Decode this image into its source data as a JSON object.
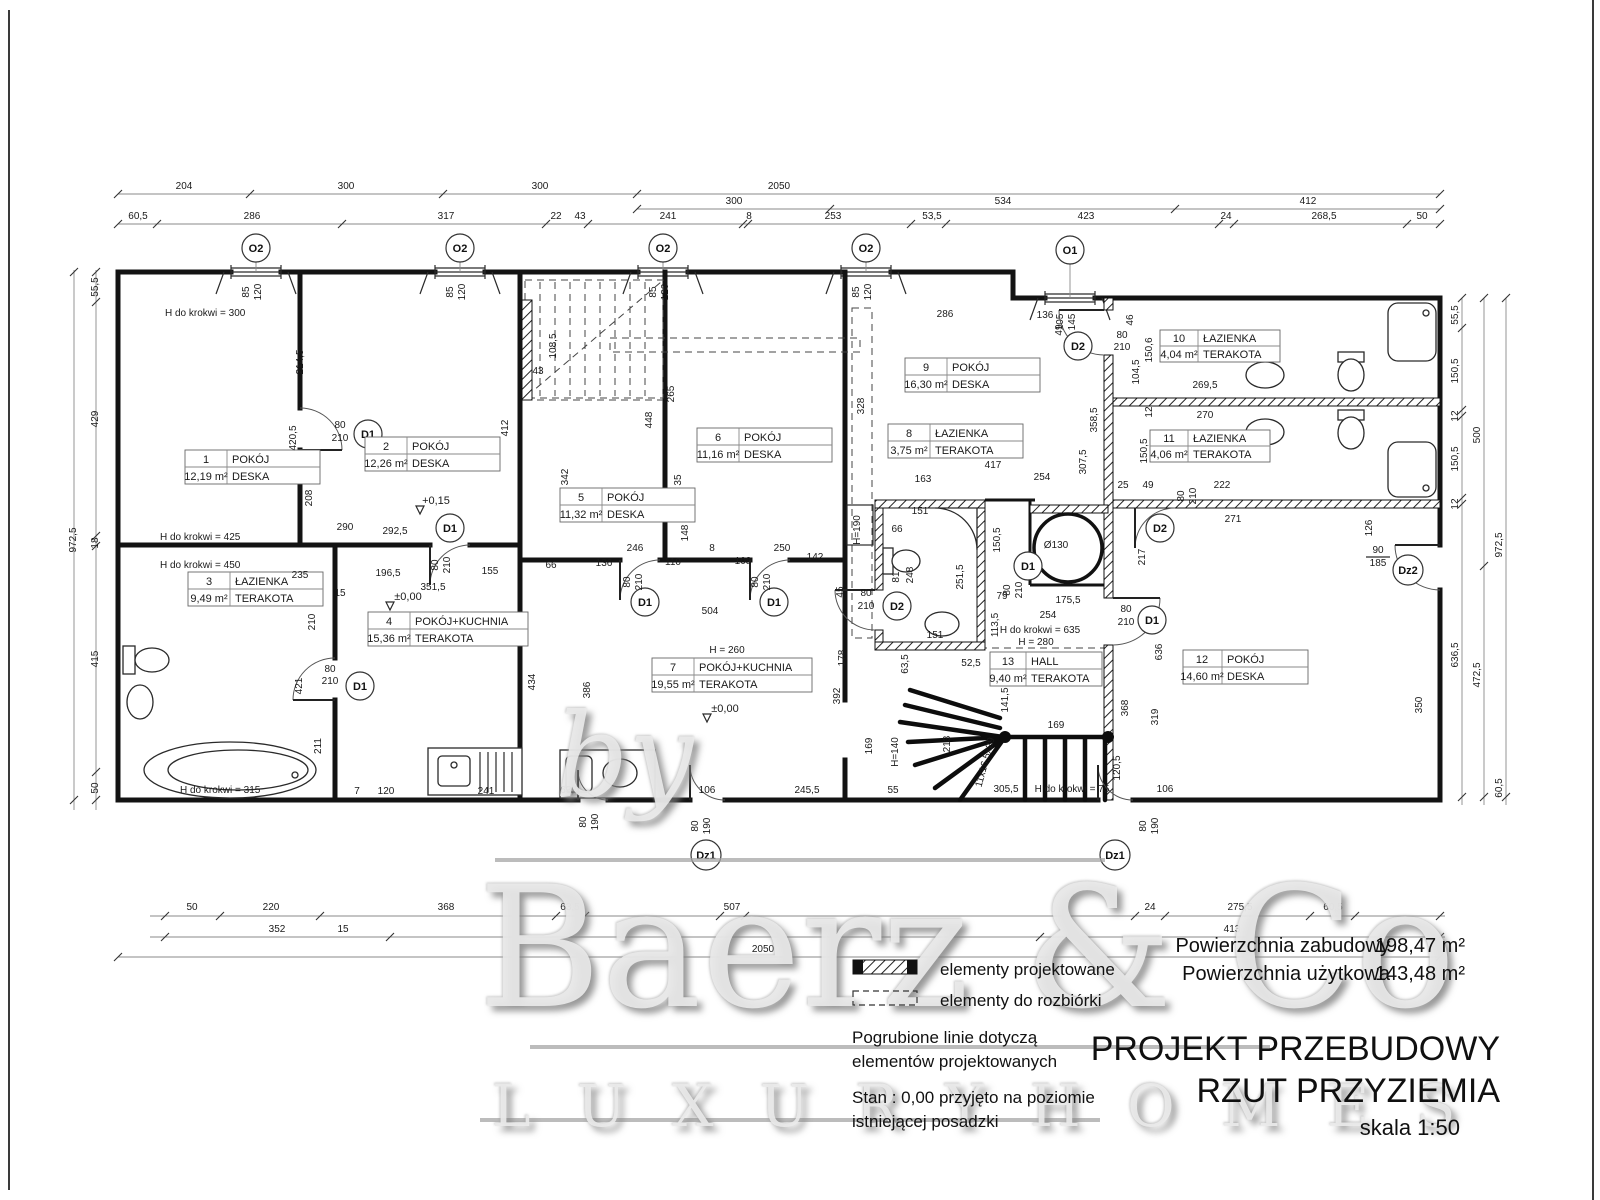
{
  "drawing": {
    "title_line1": "PROJEKT PRZEBUDOWY",
    "title_line2": "RZUT PRZYZIEMIA",
    "scale": "skala 1:50",
    "area_rows": [
      {
        "label": "Powierzchnia zabudowy",
        "value": "198,47 m²"
      },
      {
        "label": "Powierzchnia użytkowa",
        "value": "143,48 m²"
      }
    ]
  },
  "legend": {
    "item_projected": "elementy projektowane",
    "item_demolition": "elementy do rozbiórki",
    "note1a": "Pogrubione linie dotyczą",
    "note1b": "elementów projektowanych",
    "note2a": "Stan : 0,00 przyjęto na poziomie",
    "note2b": "istniejącej posadzki"
  },
  "watermark": {
    "by": "by",
    "name": "Baerz & Co",
    "tagline": "L U X U R Y   H O M E S"
  },
  "rooms": [
    {
      "num": "1",
      "name": "POKÓJ",
      "area": "12,19 m²",
      "floor": "DESKA"
    },
    {
      "num": "2",
      "name": "POKÓJ",
      "area": "12,26 m²",
      "floor": "DESKA"
    },
    {
      "num": "3",
      "name": "ŁAZIENKA",
      "area": "9,49 m²",
      "floor": "TERAKOTA"
    },
    {
      "num": "4",
      "name": "POKÓJ+KUCHNIA",
      "area": "15,36 m²",
      "floor": "TERAKOTA"
    },
    {
      "num": "5",
      "name": "POKÓJ",
      "area": "11,32 m²",
      "floor": "DESKA"
    },
    {
      "num": "6",
      "name": "POKÓJ",
      "area": "11,16 m²",
      "floor": "DESKA"
    },
    {
      "num": "7",
      "name": "POKÓJ+KUCHNIA",
      "area": "19,55 m²",
      "floor": "TERAKOTA"
    },
    {
      "num": "8",
      "name": "ŁAZIENKA",
      "area": "3,75 m²",
      "floor": "TERAKOTA"
    },
    {
      "num": "9",
      "name": "POKÓJ",
      "area": "16,30 m²",
      "floor": "DESKA"
    },
    {
      "num": "10",
      "name": "ŁAZIENKA",
      "area": "4,04 m²",
      "floor": "TERAKOTA"
    },
    {
      "num": "11",
      "name": "ŁAZIENKA",
      "area": "4,06 m²",
      "floor": "TERAKOTA"
    },
    {
      "num": "12",
      "name": "POKÓJ",
      "area": "14,60 m²",
      "floor": "DESKA"
    },
    {
      "num": "13",
      "name": "HALL",
      "area": "9,40 m²",
      "floor": "TERAKOTA"
    }
  ],
  "windows": {
    "o2": {
      "label": "O2",
      "w": "85",
      "h": "120"
    },
    "o1": {
      "label": "O1",
      "w": "105",
      "h": "145"
    }
  },
  "doors": {
    "d1": {
      "label": "D1",
      "w": "80",
      "h": "210"
    },
    "d2": {
      "label": "D2",
      "w": "80",
      "h": "210"
    },
    "dz1": {
      "label": "Dz1",
      "w": "80",
      "h": "190"
    },
    "dz2": {
      "label": "Dz2",
      "w": "90",
      "h": "185"
    }
  },
  "levels": {
    "zero": "±0,00",
    "plus": "+0,15"
  },
  "dims": {
    "top_a": [
      "204",
      "300",
      "300",
      "2050"
    ],
    "top_b": [
      "300",
      "534",
      "412"
    ],
    "top_c": [
      "60,5",
      "286",
      "317",
      "22",
      "43",
      "241",
      "8",
      "253",
      "53,5",
      "423",
      "24",
      "268,5",
      "50"
    ],
    "bottom_a": [
      "50",
      "220",
      "368",
      "63,5",
      "507",
      "24",
      "275,5",
      "60,5"
    ],
    "bottom_b": [
      "352",
      "15",
      "413"
    ],
    "bottom_total": "2050",
    "left": [
      "55,5",
      "429",
      "18",
      "415",
      "50",
      "972,5"
    ],
    "right": [
      "55,5",
      "150,5",
      "12",
      "150,5",
      "12",
      "636,5",
      "500",
      "472,5",
      "972,5",
      "60,5"
    ],
    "z12": [
      "H do krokwi = 300",
      "214,5",
      "420,5",
      "208",
      "290",
      "H do krokwi = 425",
      "H do krokwi = 450",
      "235",
      "292,5",
      "196,5",
      "155",
      "351,5",
      "66",
      "15"
    ],
    "z34": [
      "210",
      "421",
      "211",
      "H do krokwi = 315",
      "7",
      "120",
      "241",
      "434"
    ],
    "zst": [
      "108,5",
      "43",
      "265",
      "412"
    ],
    "z56": [
      "342",
      "448",
      "35",
      "148",
      "246",
      "136",
      "110",
      "8",
      "108",
      "250",
      "142",
      "504"
    ],
    "z7": [
      "H = 260",
      "386",
      "63,5",
      "106",
      "245,5",
      "55",
      "178",
      "392",
      "169",
      "H=140",
      "213"
    ],
    "z8": [
      "163",
      "254",
      "417",
      "151",
      "150,5",
      "248",
      "81",
      "251,5",
      "151",
      "63,5",
      "52,5",
      "45",
      "79",
      "113,5",
      "H=190",
      "66"
    ],
    "z9": [
      "286",
      "328",
      "358,5",
      "307,5"
    ],
    "z1011": [
      "136",
      "49",
      "46",
      "150,6",
      "104,5",
      "269,5",
      "12",
      "270",
      "150,5",
      "25",
      "49",
      "222",
      "271"
    ],
    "zh": [
      "Ø130",
      "175,5",
      "254",
      "H do krokwi = 635",
      "H = 280",
      "141,5",
      "169",
      "120,5",
      "11x16,5x29",
      "305,5",
      "H do krokwi = 75",
      "106"
    ],
    "z12r": [
      "217",
      "636",
      "319",
      "368",
      "126",
      "350"
    ]
  }
}
